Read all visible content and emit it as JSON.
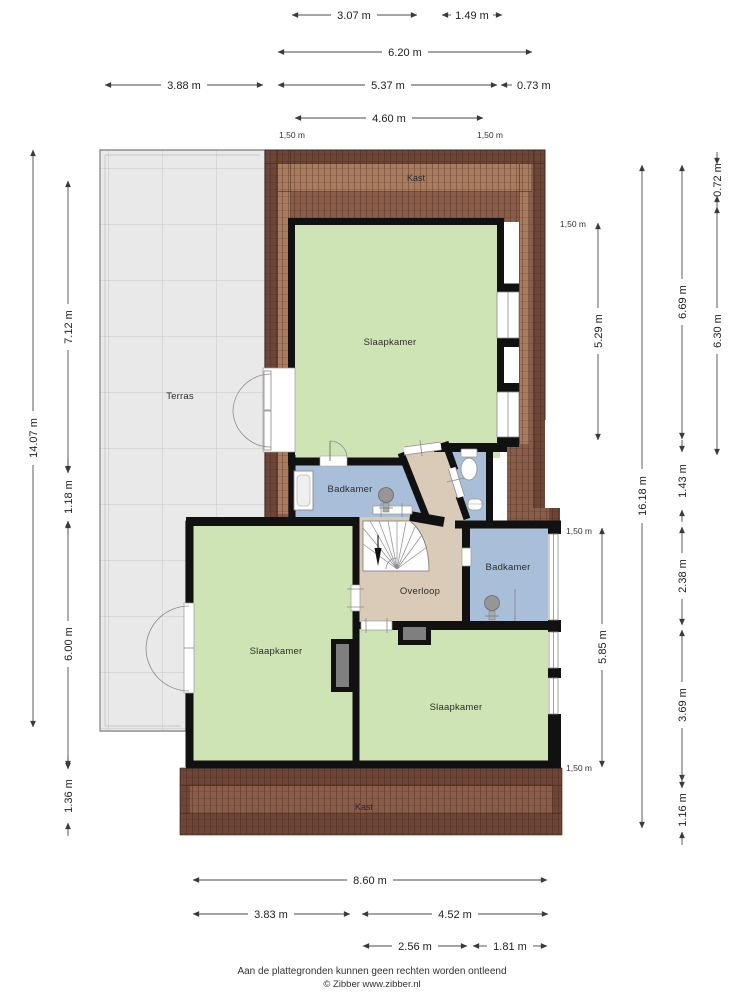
{
  "floorplan": {
    "rooms": {
      "terras": {
        "label": "Terras"
      },
      "kast_top": {
        "label": "Kast"
      },
      "slaapkamer_top": {
        "label": "Slaapkamer"
      },
      "badkamer_left": {
        "label": "Badkamer"
      },
      "badkamer_right": {
        "label": "Badkamer"
      },
      "overloop": {
        "label": "Overloop"
      },
      "slaapkamer_left": {
        "label": "Slaapkamer"
      },
      "slaapkamer_right": {
        "label": "Slaapkamer"
      },
      "kast_bottom": {
        "label": "Kast"
      }
    },
    "dimensions": {
      "top": [
        {
          "label": "3.07 m"
        },
        {
          "label": "1.49 m"
        },
        {
          "label": "6.20 m"
        },
        {
          "label": "3.88 m"
        },
        {
          "label": "5.37 m"
        },
        {
          "label": "0.73 m"
        },
        {
          "label": "4.60 m"
        }
      ],
      "left": [
        {
          "label": "14.07 m"
        },
        {
          "label": "7.12 m"
        },
        {
          "label": "1.18 m"
        },
        {
          "label": "6.00 m"
        },
        {
          "label": "1.36 m"
        }
      ],
      "right": [
        {
          "label": "0.72 m"
        },
        {
          "label": "6.69 m"
        },
        {
          "label": "6.30 m"
        },
        {
          "label": "5.29 m"
        },
        {
          "label": "16.18 m"
        },
        {
          "label": "1.43 m"
        },
        {
          "label": "2.38 m"
        },
        {
          "label": "5.85 m"
        },
        {
          "label": "3.69 m"
        },
        {
          "label": "1.16 m"
        }
      ],
      "bottom": [
        {
          "label": "8.60 m"
        },
        {
          "label": "3.83 m"
        },
        {
          "label": "4.52 m"
        },
        {
          "label": "2.56 m"
        },
        {
          "label": "1.81 m"
        }
      ],
      "knee_wall_marks": [
        {
          "label": "1,50 m"
        },
        {
          "label": "1,50 m"
        },
        {
          "label": "1,50 m"
        },
        {
          "label": "1,50 m"
        },
        {
          "label": "1,50 m"
        }
      ]
    },
    "colors": {
      "room_green": "#cee4b5",
      "room_blue": "#a9bed9",
      "hall_beige": "#d9cbb8",
      "roof_dark": "#6e4638",
      "roof_mid": "#8a5d4a",
      "roof_light": "#aa7c5f",
      "terrace_gray": "#e9e9e9",
      "wall_black": "#111111"
    }
  },
  "footer": {
    "disclaimer": "Aan de plattegronden kunnen geen rechten worden ontleend",
    "credit": "© Zibber www.zibber.nl"
  }
}
